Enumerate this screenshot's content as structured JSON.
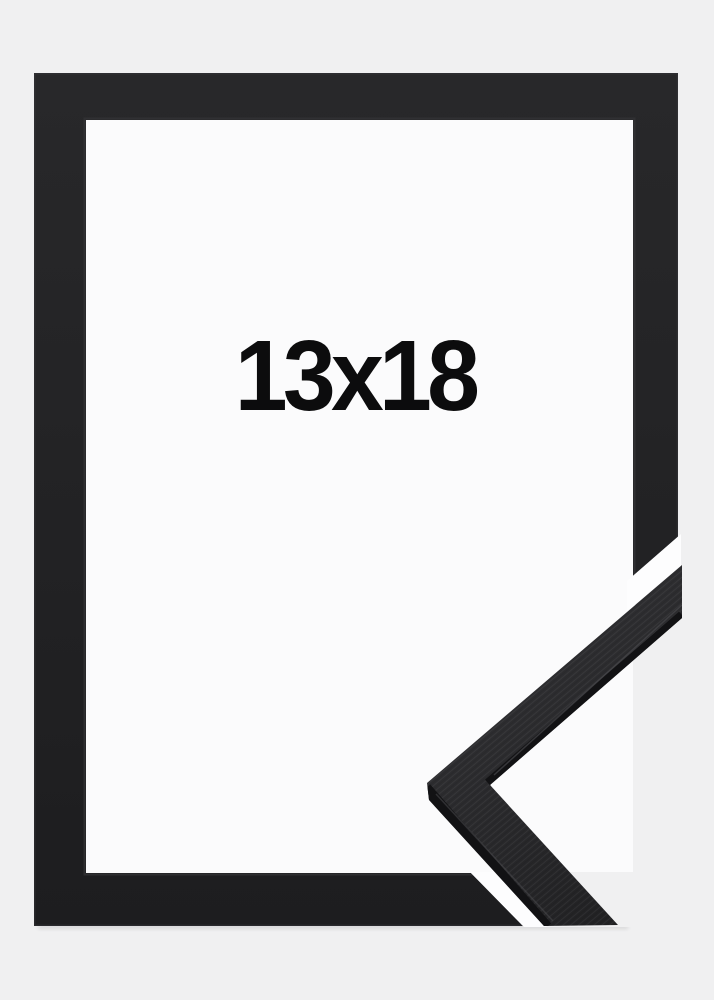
{
  "frame": {
    "size_label": "13x18"
  },
  "colors": {
    "bg": "#f0f0f1",
    "inner": "#fbfbfc",
    "frame-dark-1": "#28282a",
    "frame-dark-2": "#1d1d1f",
    "chev-face-1": "#343437",
    "chev-face-2": "#1f1f21",
    "chev-edge": "#121214",
    "sliver": "#fdfdfe",
    "label-color": "#0c0c0d"
  }
}
